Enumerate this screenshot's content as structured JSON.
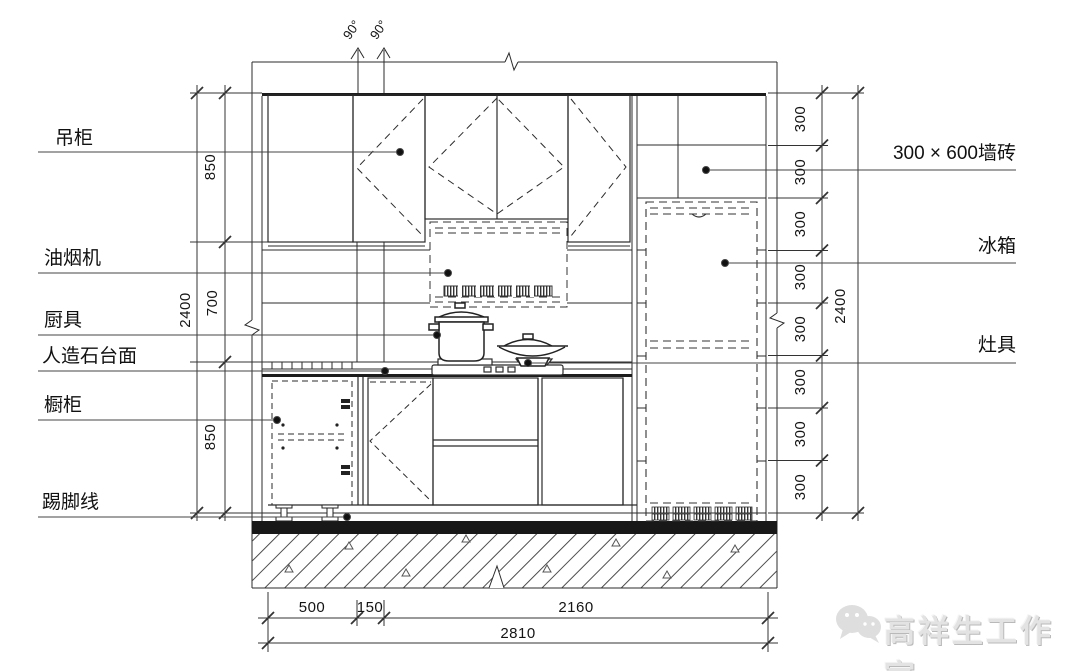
{
  "drawing": {
    "left_labels": [
      {
        "text": "吊柜"
      },
      {
        "text": "油烟机"
      },
      {
        "text": "厨具"
      },
      {
        "text": "人造石台面"
      },
      {
        "text": "橱柜"
      },
      {
        "text": "踢脚线"
      }
    ],
    "right_labels": [
      {
        "text": "300 × 600墙砖"
      },
      {
        "text": "冰箱"
      },
      {
        "text": "灶具"
      }
    ],
    "dims": {
      "left_chain": [
        "850",
        "700",
        "850"
      ],
      "left_total": "2400",
      "right_chain": [
        "300",
        "300",
        "300",
        "300",
        "300",
        "300",
        "300",
        "300"
      ],
      "right_total": "2400",
      "bottom_chain": [
        "500",
        "150",
        "2160"
      ],
      "bottom_total": "2810",
      "top_angles": [
        "90°",
        "90°"
      ]
    },
    "watermark": {
      "text": "高祥生工作室"
    },
    "line_color": "#2b2b2b"
  }
}
